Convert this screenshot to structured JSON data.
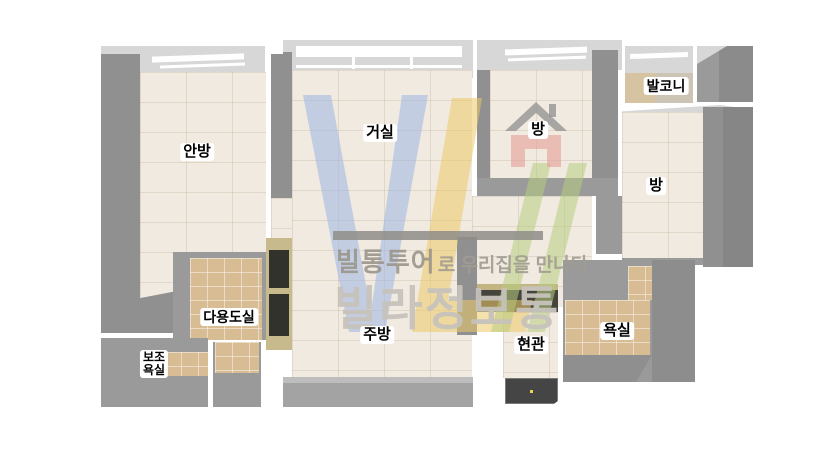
{
  "rooms": {
    "master_bedroom": {
      "label": "안방"
    },
    "living_room": {
      "label": "거실"
    },
    "room_center": {
      "label": "방"
    },
    "balcony": {
      "label": "발코니"
    },
    "room_right": {
      "label": "방"
    },
    "utility_room": {
      "label": "다용도실"
    },
    "sub_bathroom": {
      "line1": "보조",
      "line2": "욕실"
    },
    "kitchen": {
      "label": "주방"
    },
    "entrance": {
      "label": "현관"
    },
    "bathroom": {
      "label": "욕실"
    }
  },
  "watermark": {
    "tagline_brand": "빌통투어",
    "tagline_suffix": "로 우리집을 만나다",
    "big_brand": "빌라정보통"
  },
  "colors": {
    "wall_dark": "#909090",
    "wall_mid": "#9a9a9a",
    "wall_light": "#d7d7d7",
    "floor": "#f1eae0",
    "tile_tan": "#d8bd94",
    "logo_blue": "#9db5e3",
    "logo_yellow": "#edc967",
    "logo_green": "#b6cc7e",
    "logo_red": "#e49d96",
    "logo_roof_gray": "#8f8f8f"
  }
}
